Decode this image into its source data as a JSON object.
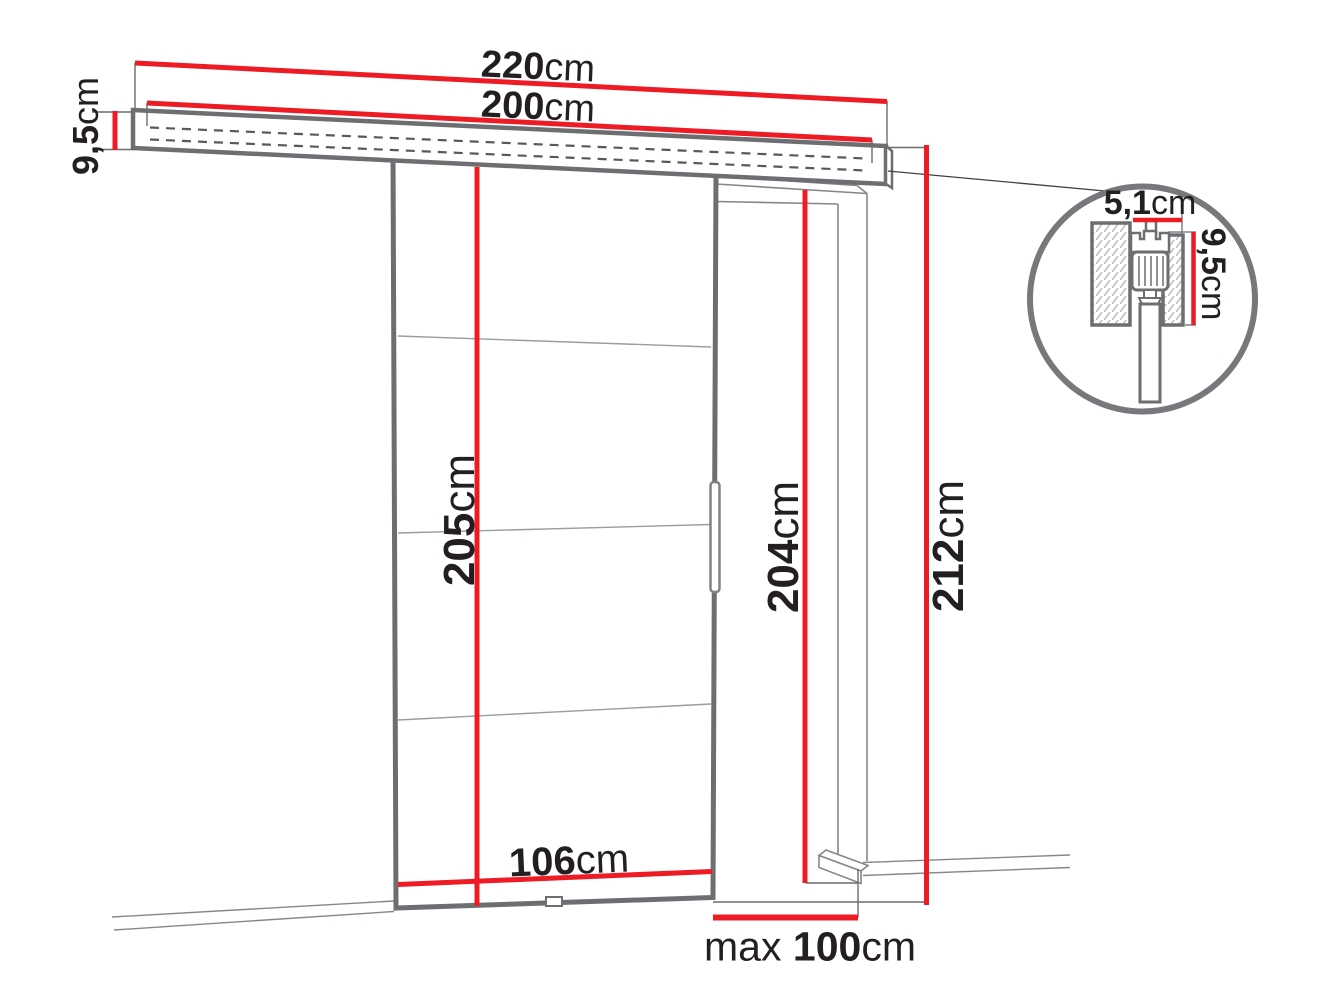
{
  "meta": {
    "description": "Technical installation diagram of a wall-mounted sliding door system with dimension callouts and a rail cross-section detail"
  },
  "colors": {
    "dimension_red": "#ed1c24",
    "outline_dark": "#6d6e71",
    "outline_light": "#85878a",
    "text": "#231f20",
    "background": "#ffffff"
  },
  "dimensions": {
    "rail_total_width": {
      "value": "220",
      "unit": "cm"
    },
    "track_width": {
      "value": "200",
      "unit": "cm"
    },
    "rail_height": {
      "value": "9,5",
      "unit": "cm"
    },
    "door_height": {
      "value": "205",
      "unit": "cm"
    },
    "opening_height": {
      "value": "204",
      "unit": "cm"
    },
    "total_height": {
      "value": "212",
      "unit": "cm"
    },
    "door_width": {
      "value": "106",
      "unit": "cm"
    },
    "max_opening_width": {
      "prefix": "max ",
      "value": "100",
      "unit": "cm"
    },
    "detail_rail_depth": {
      "value": "5,1",
      "unit": "cm"
    },
    "detail_rail_height": {
      "value": "9,5",
      "unit": "cm"
    }
  }
}
